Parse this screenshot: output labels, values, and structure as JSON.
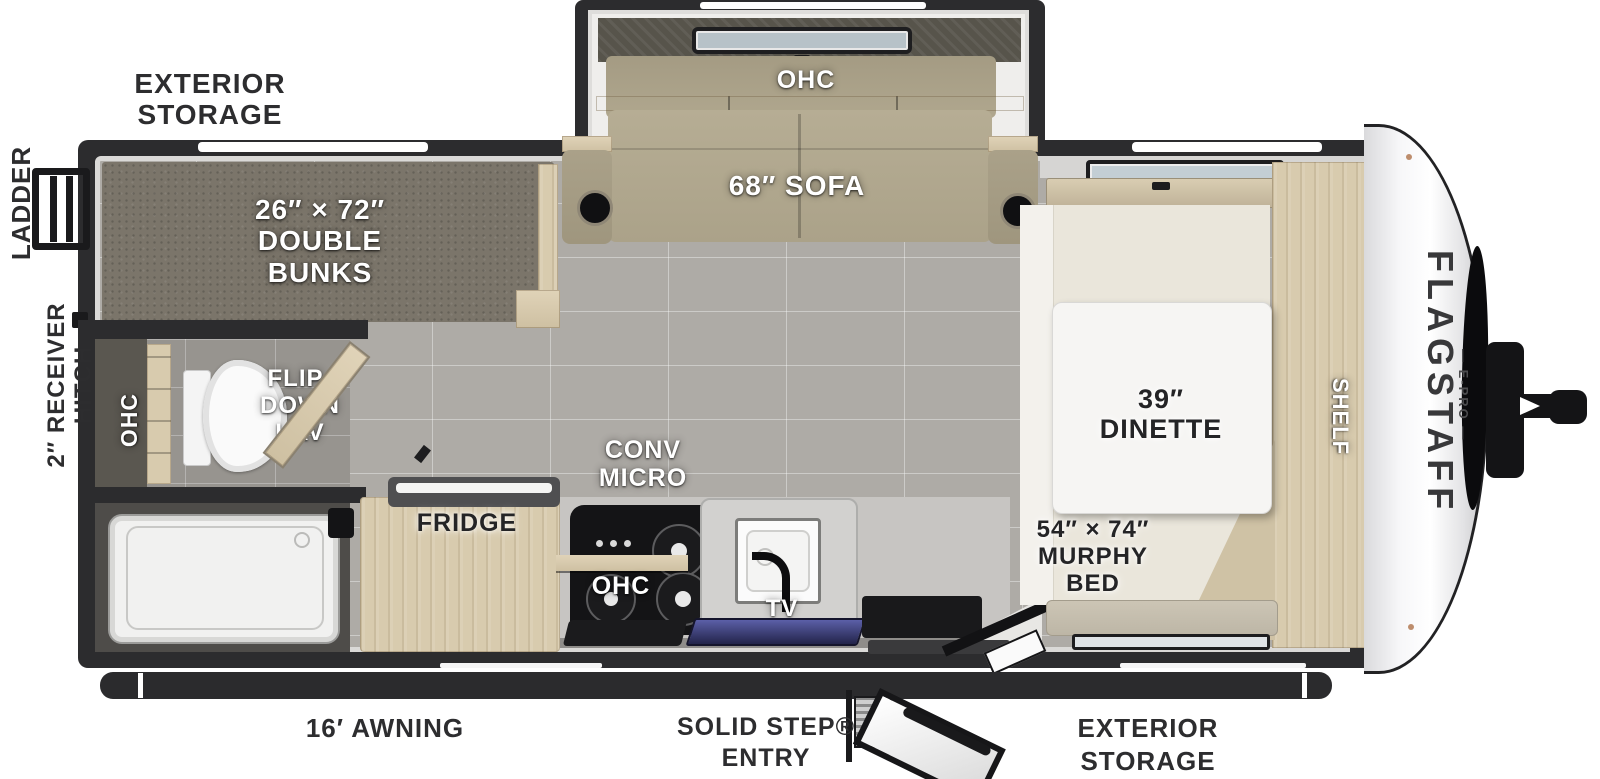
{
  "colors": {
    "wall": "#2c2c2e",
    "floor_tile": "#aeaba6",
    "bunk_carpet": "#7b756a",
    "wood": "#d8cbae",
    "sofa_fabric": "#b2a98f",
    "counter": "#c7c5c2",
    "front_cap": "#f4f4f6",
    "window_glass": "#c3ced4"
  },
  "exterior": {
    "rear": {
      "ladder": "LADDER",
      "hitch": "2″ RECEIVER HITCH",
      "storage": "EXTERIOR\nSTORAGE"
    },
    "bottom": {
      "awning": "16′ AWNING",
      "entry": "SOLID STEP®\nENTRY",
      "storage": "EXTERIOR\nSTORAGE"
    },
    "front": {
      "brand": "FLAGSTAFF",
      "model": "— E-PRO —"
    }
  },
  "rooms": {
    "bunkroom": {
      "bunks": "26″ × 72″\nDOUBLE\nBUNKS"
    },
    "bathroom": {
      "ohc": "OHC",
      "lav": "FLIP-\nDOWN\nLAV"
    },
    "living": {
      "ohc": "OHC",
      "sofa": "68″ SOFA"
    },
    "kitchen": {
      "fridge": "FRIDGE",
      "micro": "CONV\nMICRO",
      "ohc": "OHC",
      "tv": "TV"
    },
    "bedroom": {
      "dinette": "39″\nDINETTE",
      "murphy": "54″ × 74″\nMURPHY\nBED",
      "shelf": "SHELF"
    }
  }
}
